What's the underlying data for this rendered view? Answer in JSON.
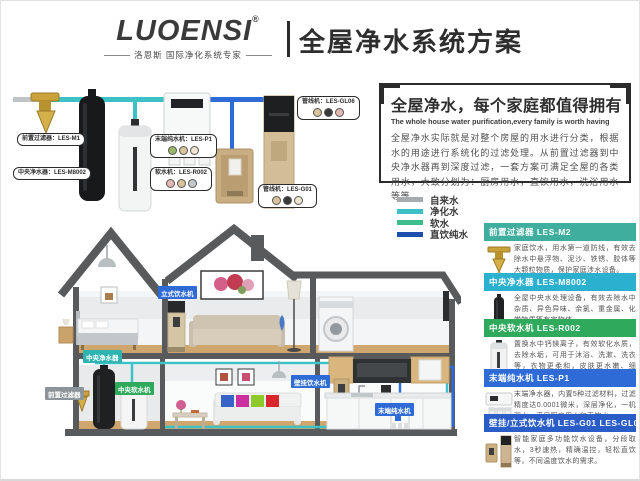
{
  "header": {
    "brand": "LUOENSI",
    "trademark": "®",
    "tagline": "洛恩斯 国际净化系统专家",
    "title": "全屋净水系统方案"
  },
  "intro": {
    "title": "全屋净水，每个家庭都值得拥有",
    "subtitle": "The whole house water purification,every family is worth having",
    "body": "全屋净水实际就是对整个房屋的用水进行分类，根据水的用途进行系统化的过滤处理。从前置过滤器到中央净水器再到深度过滤，一套方案可满足全屋的各类用水，大致分划为：厨房用水，直饮用水，洗浴用水等等。"
  },
  "legend": {
    "items": [
      {
        "label": "自来水",
        "color": "#a7abae"
      },
      {
        "label": "净化水",
        "color": "#3cc2c6"
      },
      {
        "label": "软水",
        "color": "#3dbd8b"
      },
      {
        "label": "直饮纯水",
        "color": "#1d4fae"
      }
    ]
  },
  "diagram": {
    "bubbles": [
      {
        "text": "前置过滤器：LES-M1"
      },
      {
        "text": "中央净水器：LES-M8002"
      },
      {
        "text": "末端纯水机：LES-P1"
      },
      {
        "text": "软水机：LES-R002"
      },
      {
        "text": "管线机：LES-GL06"
      },
      {
        "text": "管线机：LES-G01"
      }
    ]
  },
  "products": [
    {
      "name": "前置过滤器 LES-M2",
      "color": "#3fae9e",
      "desc": "家庭饮水，用水第一道防线，有效去除水中悬浮物、泥沙、铁锈、胶体等大颗粒物质，保护家庭涉水设备。"
    },
    {
      "name": "中央净水器 LES-M8002",
      "color": "#2bb0cf",
      "desc": "全屋中央水处理设备，有效去除水中杂质、异色异味、余氯、重金属、化学物质等有害物体。"
    },
    {
      "name": "中央软水机 LES-R002",
      "color": "#2fa95c",
      "desc": "置换水中钙镁离子，有效软化水质，去除水垢，可用于沐浴、洗漱、洗衣等，衣物更柔和，皮肤更水嫩、细腻。"
    },
    {
      "name": "末端纯水机 LES-P1",
      "color": "#2e6bd6",
      "desc": "末端净水器，内置5种过滤材料，过滤精度达0.0001微米，深层净化，一机双水，满足厨房用水和直饮水。"
    },
    {
      "name": "壁挂/立式饮水机 LES-G01 LES-GL06",
      "color": "#2a5dc8",
      "desc": "智能家庭多功能饮水设备，分段取水，3秒速热，精确温控，轻松直饮等，不同温度饮水的需求。"
    }
  ],
  "house": {
    "labels": [
      {
        "text": "立式饮水机",
        "color": "#2e6bd6"
      },
      {
        "text": "中央净水器",
        "color": "#2fb3b0"
      },
      {
        "text": "前置过滤器",
        "color": "#8d9499"
      },
      {
        "text": "中央软水机",
        "color": "#2fa95c"
      },
      {
        "text": "壁挂饮水机",
        "color": "#2e6bd6"
      },
      {
        "text": "末端纯水机",
        "color": "#2e6bd6"
      }
    ]
  },
  "colors": {
    "tap_pipe": "#c0c4c7",
    "purified_pipe": "#3cc2c6",
    "soft_pipe": "#3dbd8b",
    "pure_pipe": "#2e6bd6",
    "house_outline": "#595a5c"
  }
}
